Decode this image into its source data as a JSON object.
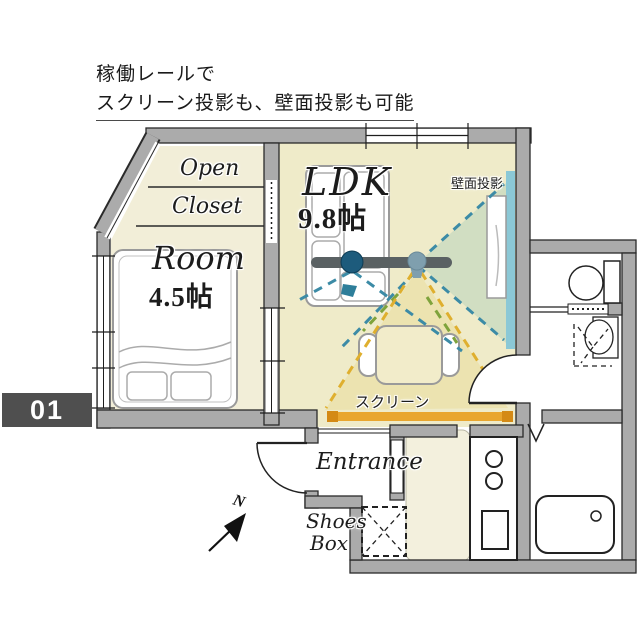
{
  "caption": {
    "line1": "稼働レールで",
    "line2": "スクリーン投影も、壁面投影も可能"
  },
  "unit_number": "01",
  "labels": {
    "ldk_name": "LDK",
    "ldk_size": "9.8帖",
    "room_name": "Room",
    "room_size": "4.5帖",
    "closet_line1": "Open",
    "closet_line2": "Closet",
    "entrance": "Entrance",
    "shoes_line1": "Shoes",
    "shoes_line2": "Box",
    "wall_projection": "壁面投影",
    "screen": "スクリーン",
    "compass_north": "N"
  },
  "colors": {
    "floor_room": "#f2eed8",
    "floor_ldk": "#efebc9",
    "floor_kitchen": "#f3f0dd",
    "wall": "#ababab",
    "rail": "#5a6163",
    "projector_active": "#1d5b7c",
    "projector_ghost": "#7f9fae",
    "beam_teal": "#3c8ba6",
    "beam_green": "#7fa33c",
    "beam_yellow": "#dfaf2e",
    "screen_bar": "#e9a62e",
    "screen_bar_cap": "#d48a15",
    "wall_projection_bar": "#8bc8d6",
    "badge_bg": "#4f4f4f"
  }
}
